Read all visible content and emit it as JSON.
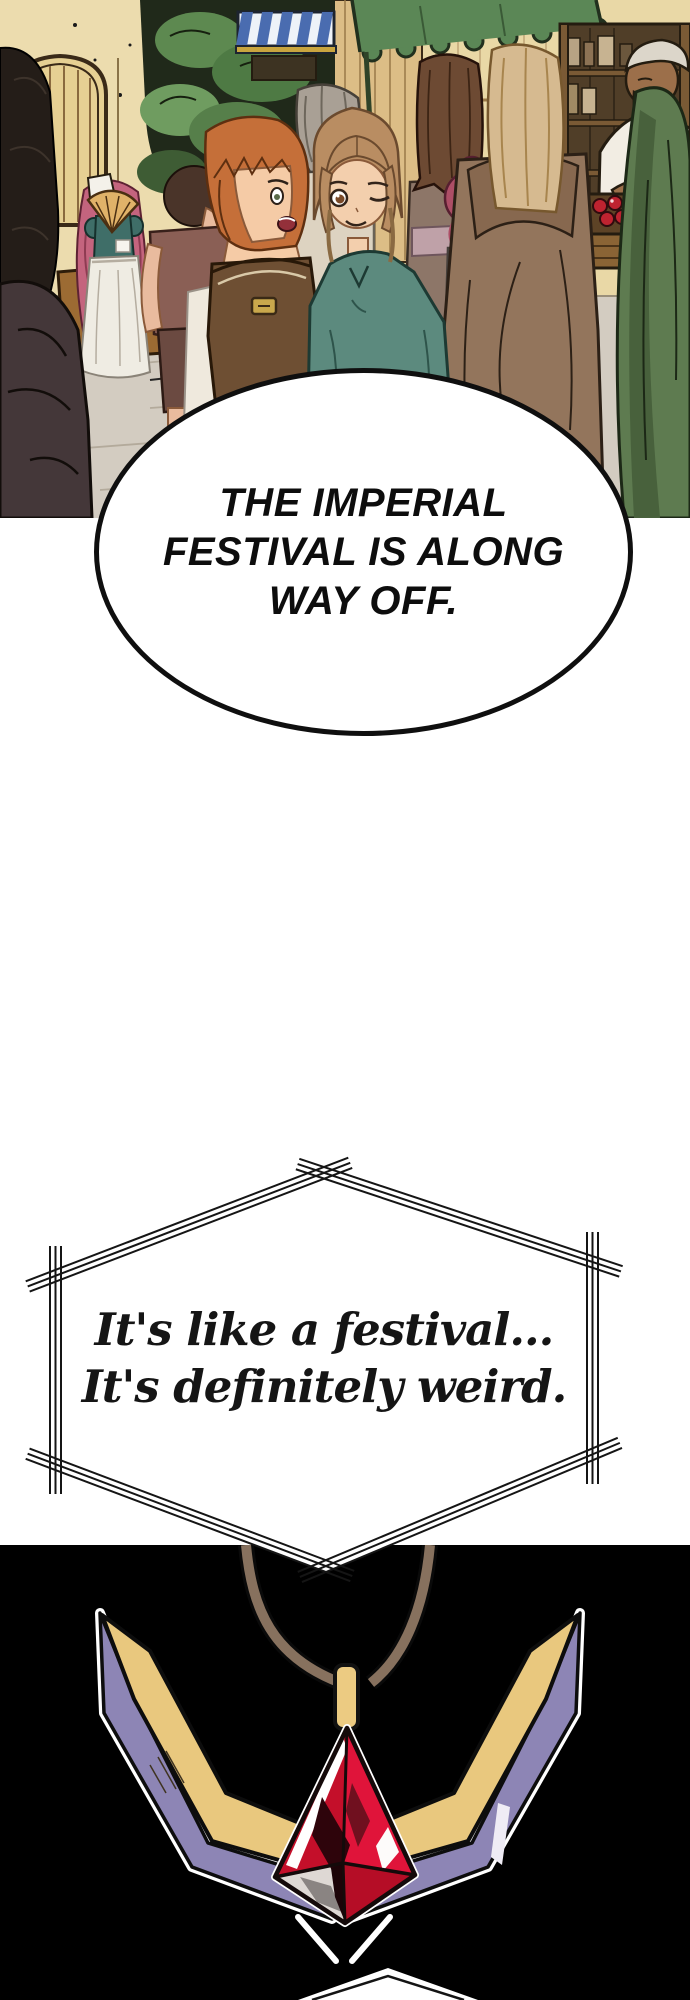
{
  "speech_bubble": {
    "lines": [
      "THE IMPERIAL",
      "FESTIVAL IS ALONG",
      "WAY OFF."
    ],
    "text": "THE IMPERIAL FESTIVAL IS ALONG WAY OFF."
  },
  "caption": {
    "lines": [
      "It's like a festival...",
      "It's definitely weird."
    ],
    "text": "It's like a festival... It's definitely weird."
  },
  "colors": {
    "ink": "#151515",
    "panel_black": "#000000",
    "gem_red": "#e0143a",
    "gem_red_deep": "#b50d26",
    "wing_gold": "#e9c87e",
    "wing_purple": "#8d85b5",
    "cord_brown": "#87715e",
    "bail_gold": "#eccb82",
    "awning_green": "#5b8756",
    "awning_blue": "#4a6cb0",
    "wall_cream": "#ecdcae",
    "pavement_gray": "#d3ccc1"
  }
}
